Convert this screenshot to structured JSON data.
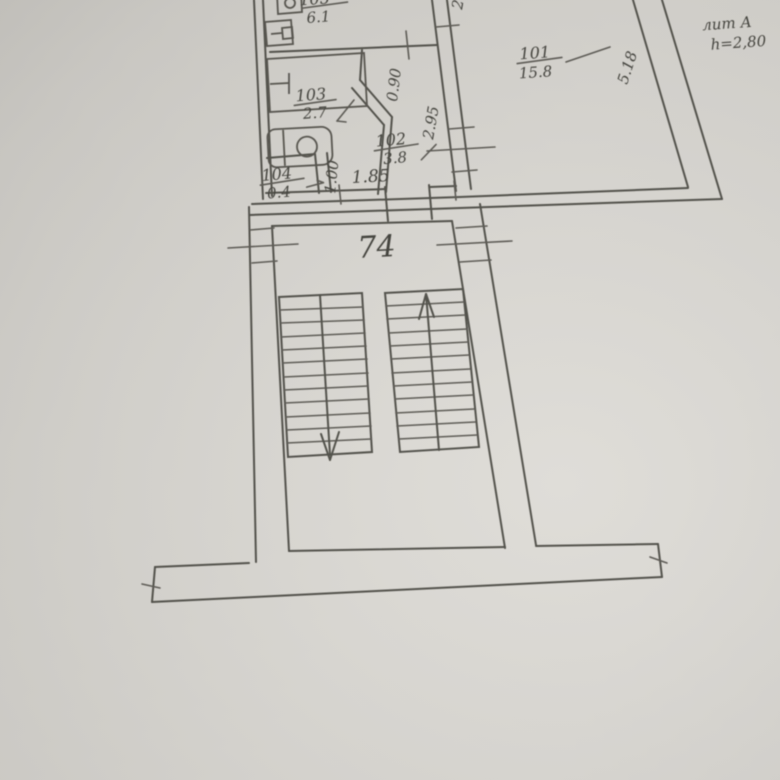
{
  "document": {
    "kind": "floor plan photo",
    "paper_color": "#d6d4cf",
    "ink_color": "#4a4842"
  },
  "title_block": {
    "building_label": "лит А",
    "height_note": "h=2,80"
  },
  "rooms": [
    {
      "number": "101",
      "area": "15.8"
    },
    {
      "number": "102",
      "area": "3.8"
    },
    {
      "number": "103",
      "area": "2.7"
    },
    {
      "number": "104",
      "area": "0.4"
    },
    {
      "number": "105",
      "area": "6.1"
    }
  ],
  "dimensions": {
    "bath_door": "0.90",
    "corridor": "2.95",
    "closet": "1.00",
    "entrance": "1.85",
    "room101_side": "5.18",
    "top_edge_partial": "2"
  },
  "stairwell": {
    "landing_label": "74"
  }
}
